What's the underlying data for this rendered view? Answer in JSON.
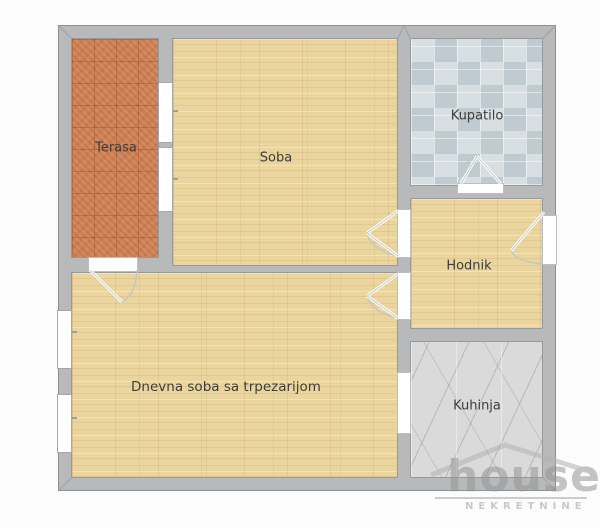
{
  "plan": {
    "type": "apartment floor plan",
    "rooms": [
      {
        "name": "Terasa",
        "floor": "terracotta tiles"
      },
      {
        "name": "Soba",
        "floor": "wood"
      },
      {
        "name": "Kupatilo",
        "floor": "ceramic tiles"
      },
      {
        "name": "Hodnik",
        "floor": "wood"
      },
      {
        "name": "Dnevna soba sa trpezarijom",
        "floor": "wood"
      },
      {
        "name": "Kuhinja",
        "floor": "marble tiles"
      }
    ]
  },
  "palette": {
    "background": "#fcfcfc",
    "wall_fill": "#b7b9ba",
    "wall_outline": "#8d9193",
    "opening_white": "#ffffff",
    "wood_floor": "#ead59e",
    "terrace_tile": "#cd7f53",
    "bath_tile": "#d7dfe3",
    "kitchen_tile": "#dadada",
    "label_color": "#3d3d39",
    "watermark_color": "#969696"
  },
  "watermark": {
    "brand": "house",
    "tagline": "NEKRETNINE"
  }
}
